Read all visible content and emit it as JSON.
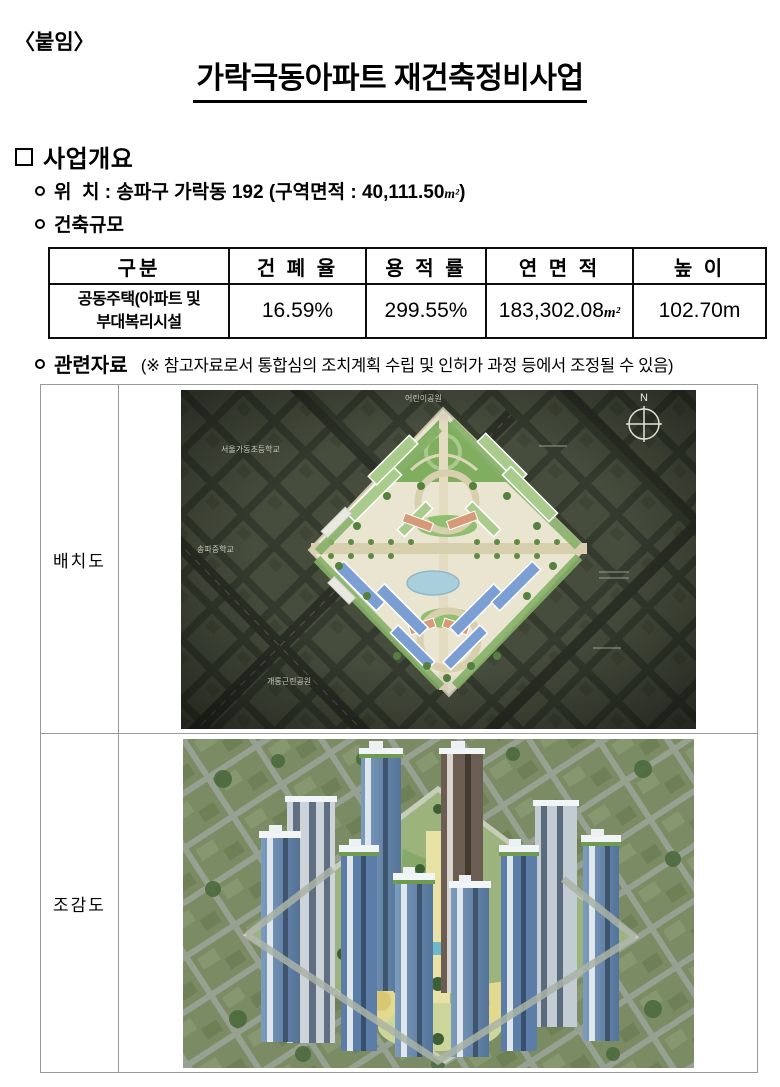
{
  "doc": {
    "attachment": "〈붙임〉",
    "title": "가락극동아파트 재건축정비사업"
  },
  "overview": {
    "heading": "사업개요",
    "location_before": "위  치 : 송파구 가락동 192 (구역면적 : 40,111.50",
    "area_unit": "m²",
    "location_after": ")",
    "scale_heading": "건축규모"
  },
  "scale_table": {
    "headers": [
      "구분",
      "건 폐 율",
      "용 적 률",
      "연 면 적",
      "높 이"
    ],
    "row": {
      "category_line1": "공동주택(아파트 및",
      "category_line2": "부대복리시설",
      "coverage_ratio": "16.59%",
      "floor_area_ratio": "299.55%",
      "gross_floor_area": "183,302.08",
      "gfa_unit": "m²",
      "height": "102.70m"
    }
  },
  "related": {
    "heading": "관련자료",
    "note": " (※ 참고자료로서 통합심의 조치계획 수립 및 인허가 과정 등에서 조정될 수 있음)"
  },
  "figures": [
    {
      "label": "배치도",
      "compass": "N",
      "map_labels": {
        "school_top": "서울가동초등학교",
        "park_top": "어린이공원",
        "school_left": "송파중학교",
        "park_bottom": "개롱근린공원"
      }
    },
    {
      "label": "조감도"
    }
  ],
  "colors": {
    "site_ground": "#eae5d1",
    "bg_city_dark": "#474c3d",
    "tower_blue": "#63809f",
    "roof_green": "#6f9a4f",
    "pond_blue": "#a9cfdd"
  }
}
